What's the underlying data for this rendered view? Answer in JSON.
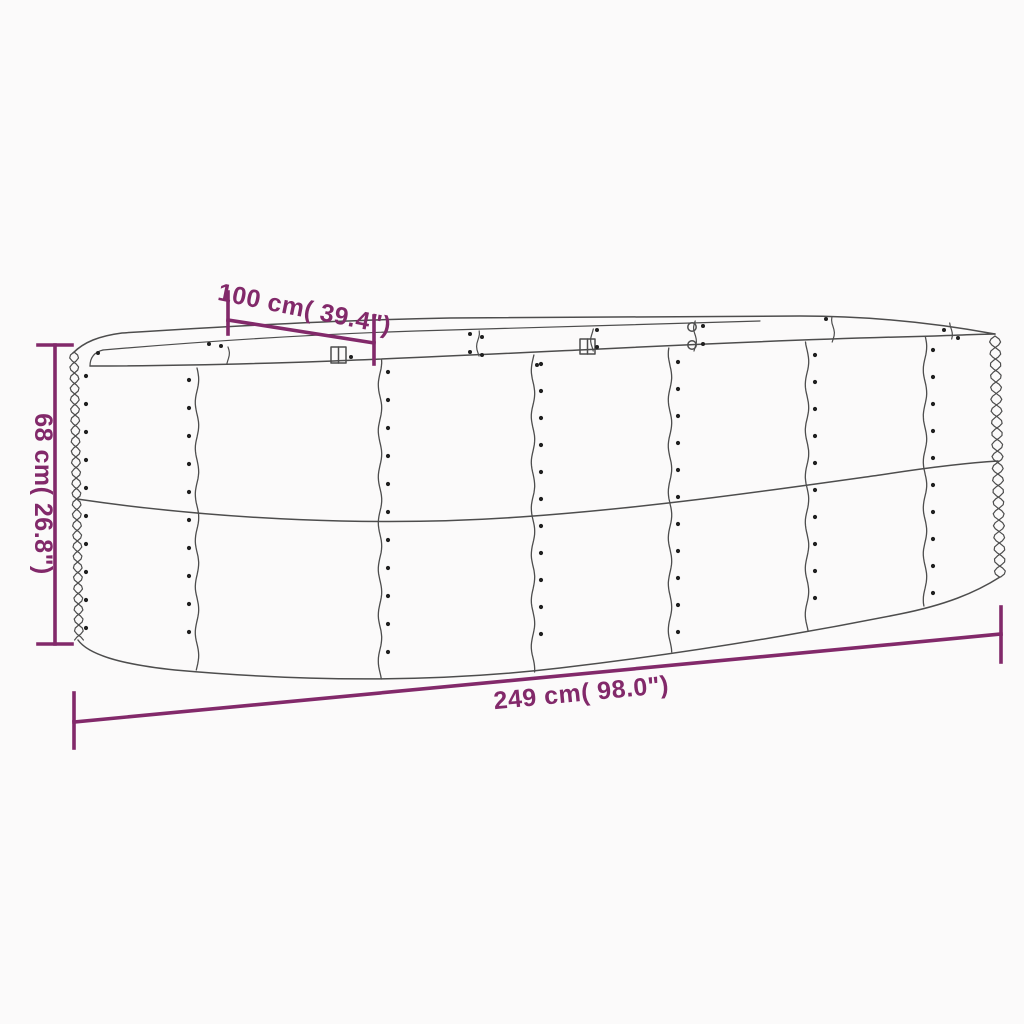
{
  "page": {
    "background_color": "#fbfafa"
  },
  "diagram": {
    "subject": "oval corrugated metal raised garden bed - dimension drawing",
    "style": {
      "accent_color": "#82296a",
      "line_color": "#4d4d4d",
      "rivet_color": "#1f1f1f"
    },
    "dimensions": {
      "width": {
        "label": "100 cm( 39.4\")"
      },
      "height": {
        "label": "68 cm( 26.8\")"
      },
      "length": {
        "label": "249 cm( 98.0\")"
      }
    }
  }
}
